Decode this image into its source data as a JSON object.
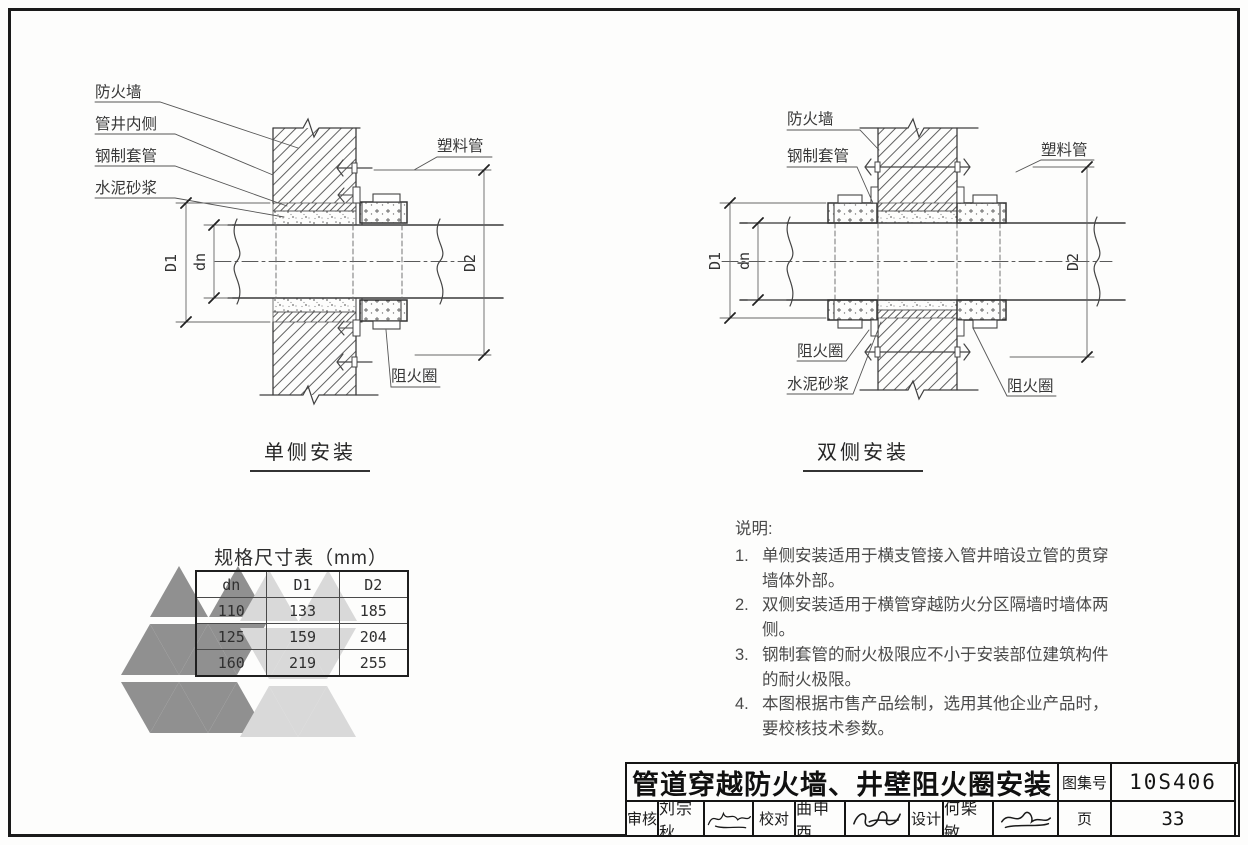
{
  "diagram_left": {
    "caption": "单侧安装",
    "labels": {
      "firewall": "防火墙",
      "shaft_inner": "管井内侧",
      "steel_sleeve": "钢制套管",
      "cement_mortar": "水泥砂浆",
      "plastic_pipe": "塑料管",
      "fire_collar": "阻火圈",
      "dim_d1": "D1",
      "dim_dn": "dn",
      "dim_d2": "D2"
    }
  },
  "diagram_right": {
    "caption": "双侧安装",
    "labels": {
      "firewall": "防火墙",
      "steel_sleeve": "钢制套管",
      "plastic_pipe": "塑料管",
      "fire_collar_left": "阻火圈",
      "cement_mortar": "水泥砂浆",
      "fire_collar_right": "阻火圈",
      "dim_d1": "D1",
      "dim_dn": "dn",
      "dim_d2": "D2"
    }
  },
  "spec_table": {
    "title": "规格尺寸表（mm）",
    "columns": [
      "dn",
      "D1",
      "D2"
    ],
    "rows": [
      [
        "110",
        "133",
        "185"
      ],
      [
        "125",
        "159",
        "204"
      ],
      [
        "160",
        "219",
        "255"
      ]
    ]
  },
  "notes": {
    "heading": "说明:",
    "items": [
      {
        "num": "1.",
        "text": "单侧安装适用于横支管接入管井暗设立管的贯穿墙体外部。"
      },
      {
        "num": "2.",
        "text": "双侧安装适用于横管穿越防火分区隔墙时墙体两侧。"
      },
      {
        "num": "3.",
        "text": "钢制套管的耐火极限应不小于安装部位建筑构件的耐火极限。"
      },
      {
        "num": "4.",
        "text": "本图根据市售产品绘制，选用其他企业产品时，要校核技术参数。"
      }
    ]
  },
  "title_block": {
    "title": "管道穿越防火墙、井壁阻火圈安装",
    "atlas_no_label": "图集号",
    "atlas_no": "10S406",
    "reviewer_label": "审核",
    "reviewer": "刘宗秋",
    "proofreader_label": "校对",
    "proofreader": "曲申西",
    "designer_label": "设计",
    "designer": "何柴敏",
    "page_label": "页",
    "page_no": "33"
  },
  "watermark": {
    "dark_color": "#909090",
    "light_color": "#d9d9d9"
  }
}
